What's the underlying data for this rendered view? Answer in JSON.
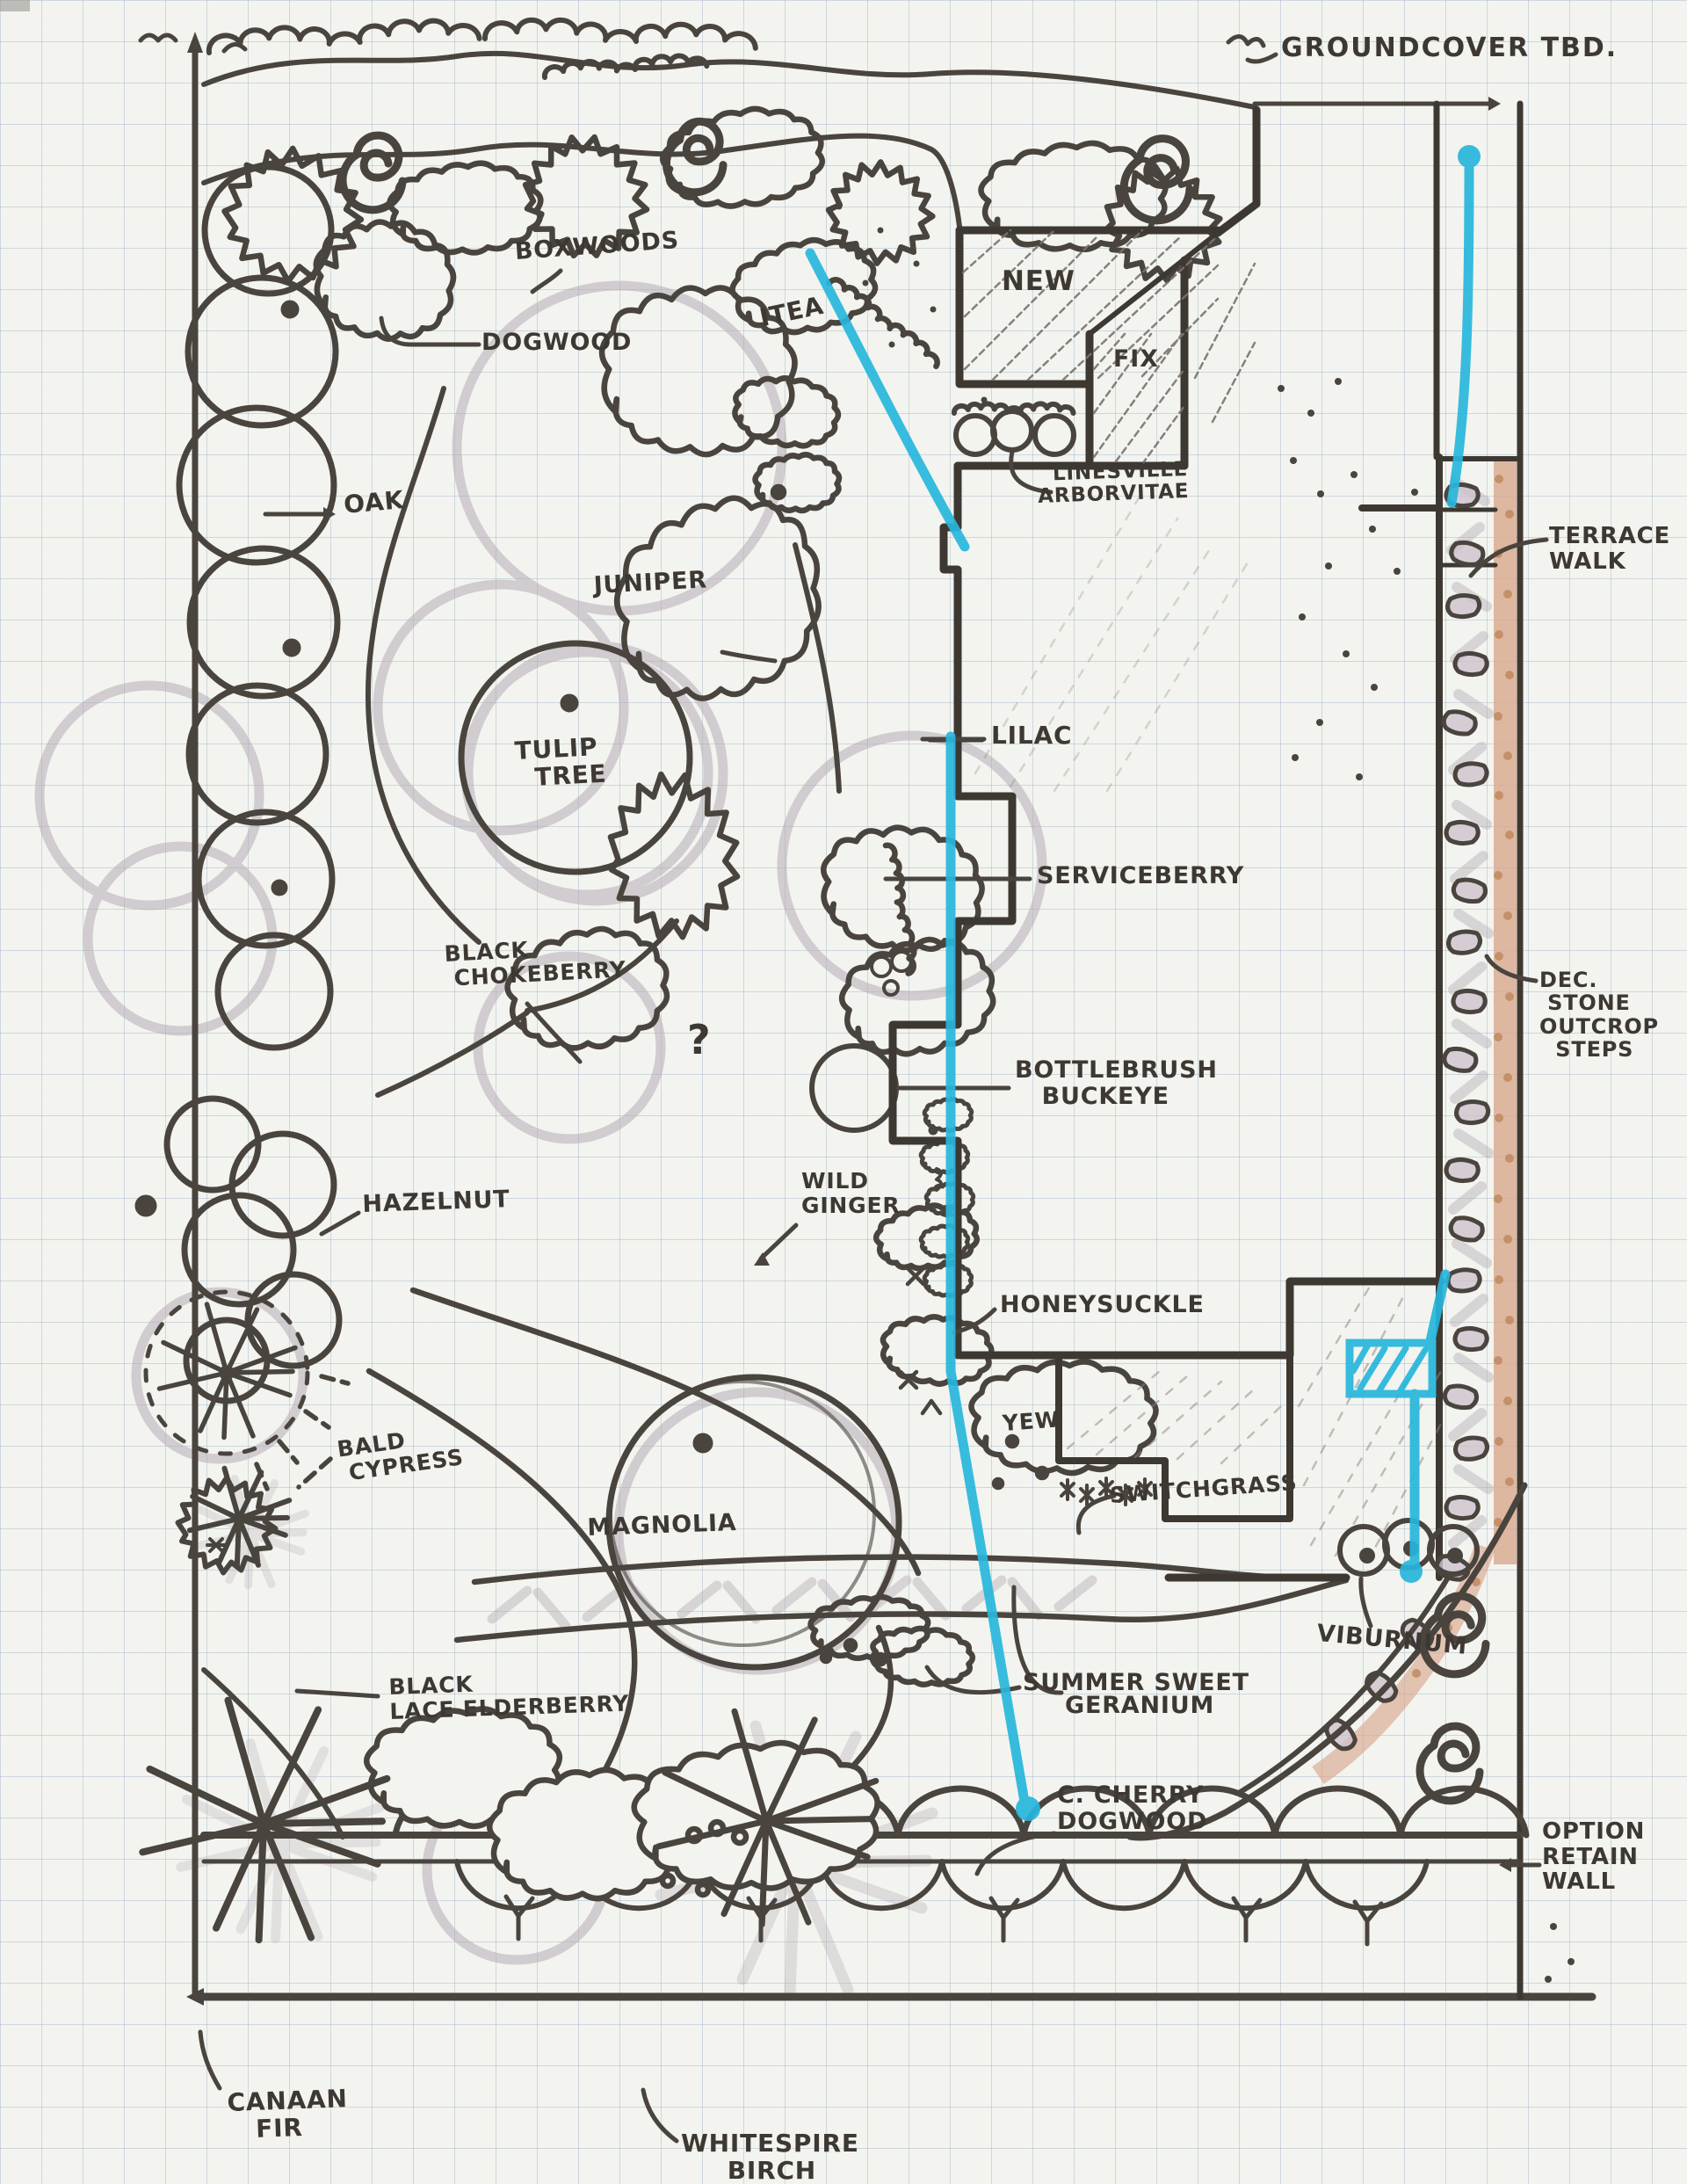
{
  "page": {
    "kind": "hand-drawn landscape planting plan on graph paper",
    "media": "marker sketch with cyan highlighter and pencil shading"
  },
  "colors": {
    "paper": "#f3f4ef",
    "grid": "#7894b4",
    "ink": "#4a443e",
    "wall_ink": "#3e3832",
    "pencil_gray": "#b4abb5",
    "marker_cyan": "#27b6dc",
    "stone_tan": "#d8a78d",
    "stone_dot": "#bf8a61"
  },
  "labels": {
    "groundcover_tbd": "GROUNDCOVER TBD.",
    "boxwoods": "BOXWOODS",
    "itea": "ITEA",
    "dogwood": "DOGWOOD",
    "oak": "OAK",
    "juniper": "JUNIPER",
    "new_area": "NEW",
    "fix_area": "FIX",
    "linesville_arborvitae": "  LINESVILLE\nARBORVITAE",
    "terrace_walk": "TERRACE\nWALK",
    "tulip_tree": "TULIP\n  TREE",
    "lilac": "LILAC",
    "black_chokeberry": "BLACK\n CHOKEBERRY",
    "serviceberry": "SERVICEBERRY",
    "bottlebrush_buckeye": "BOTTLEBRUSH\n   BUCKEYE",
    "wild_ginger": "WILD\nGINGER",
    "honeysuckle": "HONEYSUCKLE",
    "hazelnut": "HAZELNUT",
    "yew": "YEW",
    "switchgrass": "SWITCHGRASS",
    "bald_cypress": "BALD\n CYPRESS",
    "magnolia": "MAGNOLIA",
    "geranium": "GERANIUM",
    "viburnum": "VIBURNUM",
    "summer_sweet": "SUMMER SWEET",
    "c_cherry_dogwood": "C. CHERRY\nDOGWOOD",
    "option_retain_wall": "OPTION\nRETAIN\nWALL",
    "canaan_fir": "CANAAN\n   FIR",
    "whitespire_birch": "WHITESPIRE\n     BIRCH",
    "dec_stone_outcrop_steps": "DEC.\n STONE\nOUTCROP\n  STEPS",
    "question_mark": "?"
  }
}
